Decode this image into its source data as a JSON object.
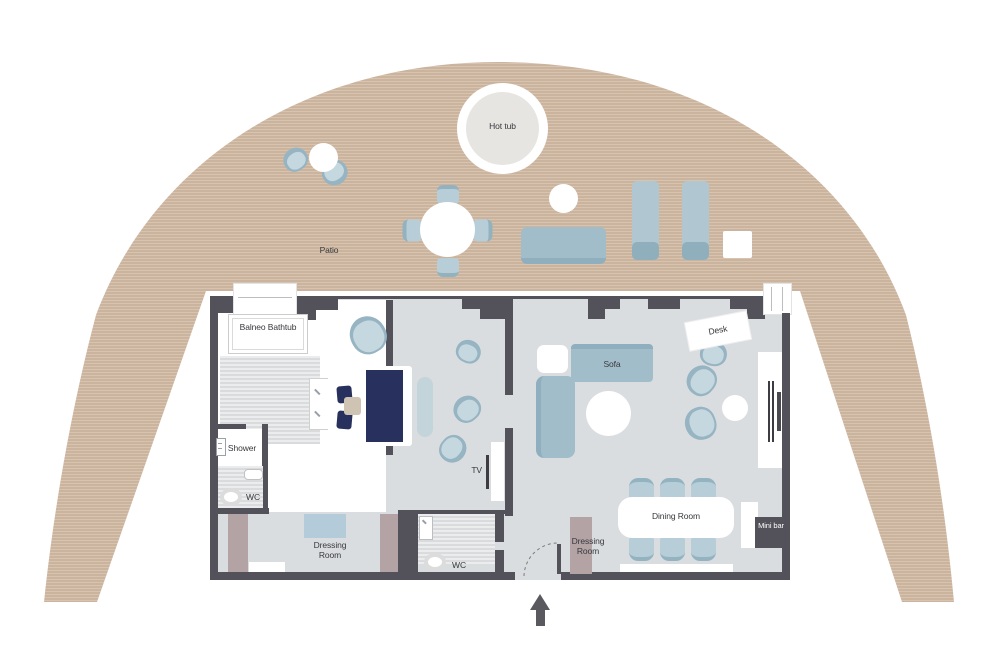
{
  "title": "Suite floor plan with patio",
  "labels": {
    "patio": "Patio",
    "hot_tub": "Hot tub",
    "balneo_bathtub": "Balneo Bathtub",
    "shower": "Shower",
    "wc_left": "WC",
    "wc_middle": "WC",
    "dressing_room_left": "Dressing Room",
    "dressing_room_entry": "Dressing Room",
    "tv": "TV",
    "sofa": "Sofa",
    "desk": "Desk",
    "dining_room": "Dining Room",
    "mini_bar": "Mini bar"
  },
  "colors": {
    "deck": "#cbb49e",
    "deck_stripe": "#d7c3af",
    "wall": "#53525a",
    "floor": "#dadde0",
    "furniture_blue": "#a2bdca",
    "chair_blue": "#c5d7df",
    "navy": "#28315d",
    "mauve": "#b3a3a5",
    "accent_pillow": "#cfc3b4",
    "label_text": "#38383d"
  }
}
